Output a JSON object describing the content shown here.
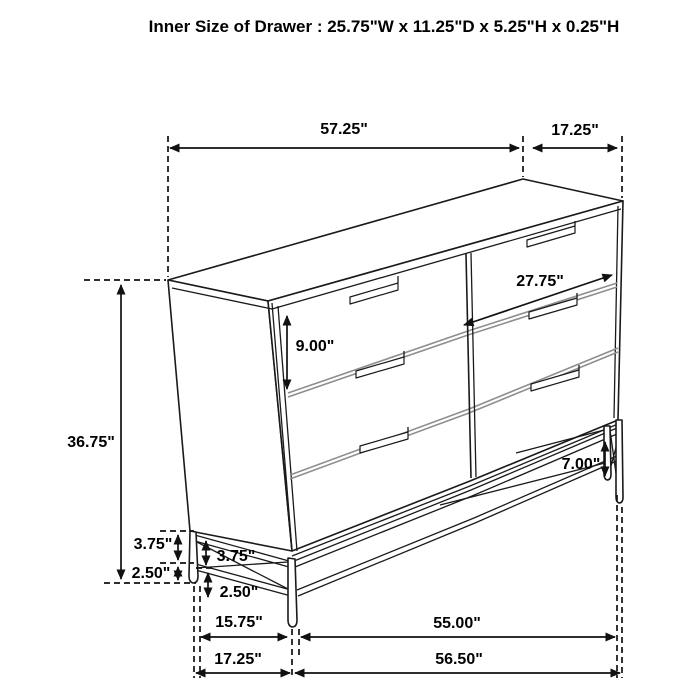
{
  "title": "Inner Size of Drawer : 25.75\"W x 11.25\"D x 5.25\"H x 0.25\"H",
  "dims": {
    "top_width": "57.25\"",
    "top_depth": "17.25\"",
    "height": "36.75\"",
    "drawer_width": "27.75\"",
    "drawer_height": "9.00\"",
    "leg_height": "7.00\"",
    "frame_upper_outer": "3.75\"",
    "frame_upper_inner": "3.75\"",
    "frame_lower_outer": "2.50\"",
    "frame_lower_inner": "2.50\"",
    "base_inner_depth": "15.75\"",
    "base_inner_width": "55.00\"",
    "base_outer_depth": "17.25\"",
    "base_outer_width": "56.50\""
  },
  "colors": {
    "line": "#1a1a1a",
    "secondary_line": "#8e8e8e",
    "text": "#000000",
    "background": "#ffffff"
  },
  "object": "six-drawer dresser with metal base frame, perspective line drawing"
}
